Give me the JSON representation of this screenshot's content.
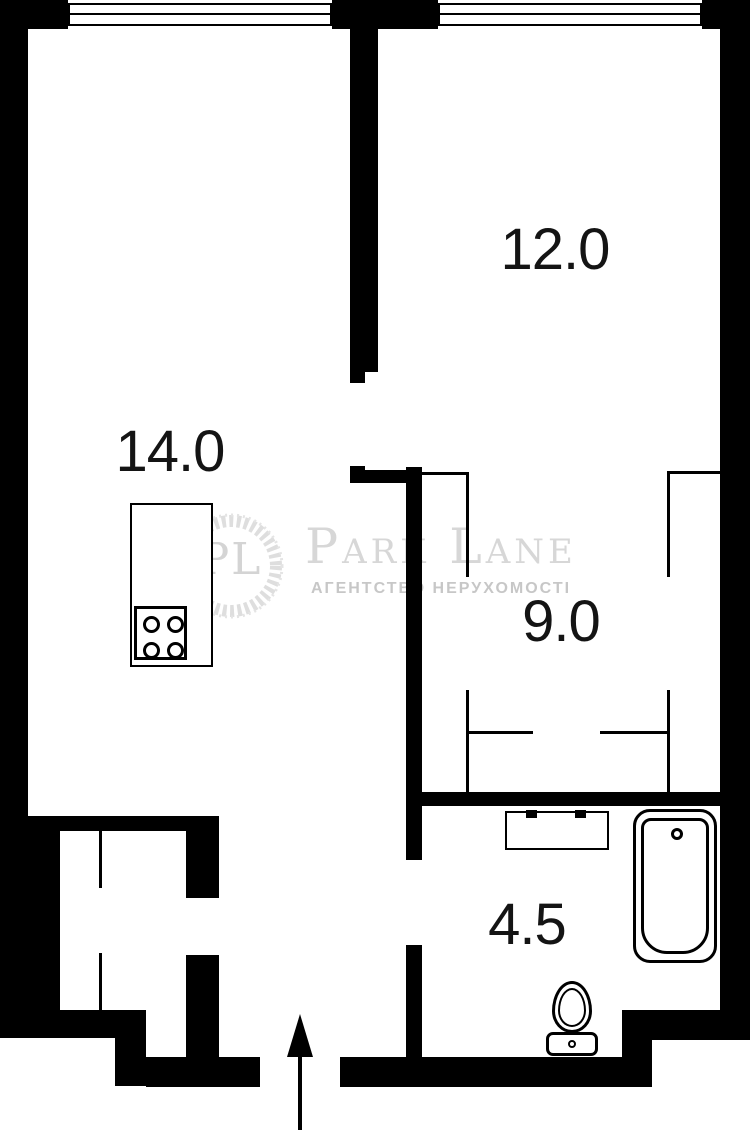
{
  "page": {
    "background": "#ffffff",
    "wall_color": "#000000",
    "label_color": "#141414"
  },
  "rooms": [
    {
      "id": "kitchen-living",
      "label": "14.0",
      "area_sqm": 14.0,
      "center": [
        170,
        452
      ]
    },
    {
      "id": "living-room",
      "label": "12.0",
      "area_sqm": 12.0,
      "center": [
        555,
        250
      ]
    },
    {
      "id": "bedroom",
      "label": "9.0",
      "area_sqm": 9.0,
      "center": [
        561,
        622
      ]
    },
    {
      "id": "bathroom",
      "label": "4.5",
      "area_sqm": 4.5,
      "center": [
        527,
        925
      ]
    }
  ],
  "watermark": {
    "monogram": "PL",
    "title": "Park Lane",
    "subtitle": "АГЕНТСТВО НЕРУХОМОСТІ",
    "title_color": "#d7d7d7",
    "subtitle_color": "#c7c7c7",
    "wreath_color": "#dedede"
  },
  "plan": {
    "walls": [
      {
        "name": "top-wall-left",
        "rect": [
          0,
          0,
          68,
          29
        ]
      },
      {
        "name": "top-wall-mid",
        "rect": [
          332,
          0,
          106,
          29
        ]
      },
      {
        "name": "top-wall-right",
        "rect": [
          702,
          0,
          48,
          29
        ]
      },
      {
        "name": "left-wall",
        "rect": [
          0,
          0,
          28,
          832
        ]
      },
      {
        "name": "left-wall-thick",
        "rect": [
          0,
          816,
          60,
          195
        ]
      },
      {
        "name": "closet-floor-wall",
        "rect": [
          0,
          1010,
          146,
          28
        ]
      },
      {
        "name": "entry-step-wall",
        "rect": [
          115,
          1038,
          31,
          48
        ]
      },
      {
        "name": "bottom-wall-left",
        "rect": [
          146,
          1057,
          114,
          30
        ]
      },
      {
        "name": "bottom-wall-right",
        "rect": [
          340,
          1057,
          312,
          30
        ]
      },
      {
        "name": "step-wall-vertical",
        "rect": [
          622,
          1010,
          30,
          77
        ]
      },
      {
        "name": "step-wall-horizontal",
        "rect": [
          622,
          1010,
          100,
          30
        ]
      },
      {
        "name": "right-wall",
        "rect": [
          720,
          0,
          30,
          1040
        ]
      },
      {
        "name": "divider-wall",
        "rect": [
          350,
          28,
          28,
          344
        ]
      },
      {
        "name": "divider-door-jamb",
        "rect": [
          350,
          372,
          15,
          11
        ]
      },
      {
        "name": "mid-wall-jamb",
        "rect": [
          350,
          466,
          15,
          8
        ]
      },
      {
        "name": "mid-wall",
        "rect": [
          350,
          470,
          70,
          13
        ]
      },
      {
        "name": "corridor-wall-upper",
        "rect": [
          406,
          467,
          16,
          393
        ]
      },
      {
        "name": "corridor-wall-lower",
        "rect": [
          406,
          945,
          16,
          112
        ]
      },
      {
        "name": "bathroom-wall",
        "rect": [
          422,
          792,
          298,
          14
        ]
      },
      {
        "name": "kitchen-bottom-wall",
        "rect": [
          0,
          816,
          219,
          15
        ]
      },
      {
        "name": "closet-wall-upper",
        "rect": [
          186,
          831,
          33,
          67
        ]
      },
      {
        "name": "closet-wall-lower",
        "rect": [
          186,
          955,
          33,
          103
        ]
      }
    ],
    "partitions": [
      {
        "name": "partition-top-left-h",
        "rect": [
          422,
          472,
          46,
          3
        ]
      },
      {
        "name": "partition-top-left-v",
        "rect": [
          466,
          472,
          3,
          105
        ]
      },
      {
        "name": "partition-top-right-h",
        "rect": [
          667,
          471,
          53,
          3
        ]
      },
      {
        "name": "partition-top-right-v",
        "rect": [
          667,
          471,
          3,
          106
        ]
      },
      {
        "name": "partition-bottom-left-v",
        "rect": [
          466,
          690,
          3,
          102
        ]
      },
      {
        "name": "partition-bottom-left-h",
        "rect": [
          466,
          731,
          67,
          3
        ]
      },
      {
        "name": "partition-bottom-right-v",
        "rect": [
          667,
          690,
          3,
          102
        ]
      },
      {
        "name": "partition-bottom-right-h",
        "rect": [
          600,
          731,
          67,
          3
        ]
      },
      {
        "name": "closet-partition-upper",
        "rect": [
          99,
          831,
          3,
          57
        ]
      },
      {
        "name": "closet-partition-lower",
        "rect": [
          99,
          953,
          3,
          57
        ]
      }
    ],
    "windows": [
      {
        "name": "window-left",
        "rect": [
          68,
          3,
          264,
          23
        ]
      },
      {
        "name": "window-right",
        "rect": [
          438,
          3,
          264,
          23
        ]
      }
    ]
  },
  "fixtures": {
    "kitchen_counter": {
      "rect": [
        130,
        503,
        83,
        164
      ]
    },
    "stove": {
      "rect": [
        134,
        606,
        53,
        54
      ],
      "burners": [
        [
          14,
          15
        ],
        [
          38,
          15
        ],
        [
          14,
          41
        ],
        [
          38,
          41
        ]
      ]
    },
    "sink_counter": {
      "rect": [
        505,
        811,
        104,
        39
      ],
      "basins": [
        [
          510,
          818,
          42,
          26
        ],
        [
          559,
          818,
          42,
          26
        ]
      ],
      "faucets": [
        [
          526,
          810,
          11,
          8
        ],
        [
          575,
          810,
          11,
          8
        ]
      ]
    },
    "bathtub": {
      "outer": [
        633,
        809,
        84,
        154
      ],
      "inner": [
        641,
        818,
        68,
        136
      ],
      "drain": [
        671,
        828,
        12,
        12
      ]
    },
    "toilet": {
      "bowl": [
        552,
        981,
        40,
        52
      ],
      "bowl_inner": [
        558,
        988,
        28,
        39
      ],
      "tank": [
        546,
        1032,
        52,
        24
      ],
      "knob": [
        568,
        1040,
        8,
        8
      ]
    }
  },
  "entrance_arrow": {
    "head": [
      287,
      1014,
      0,
      0
    ],
    "shaft": [
      298,
      1056,
      4,
      74
    ]
  }
}
